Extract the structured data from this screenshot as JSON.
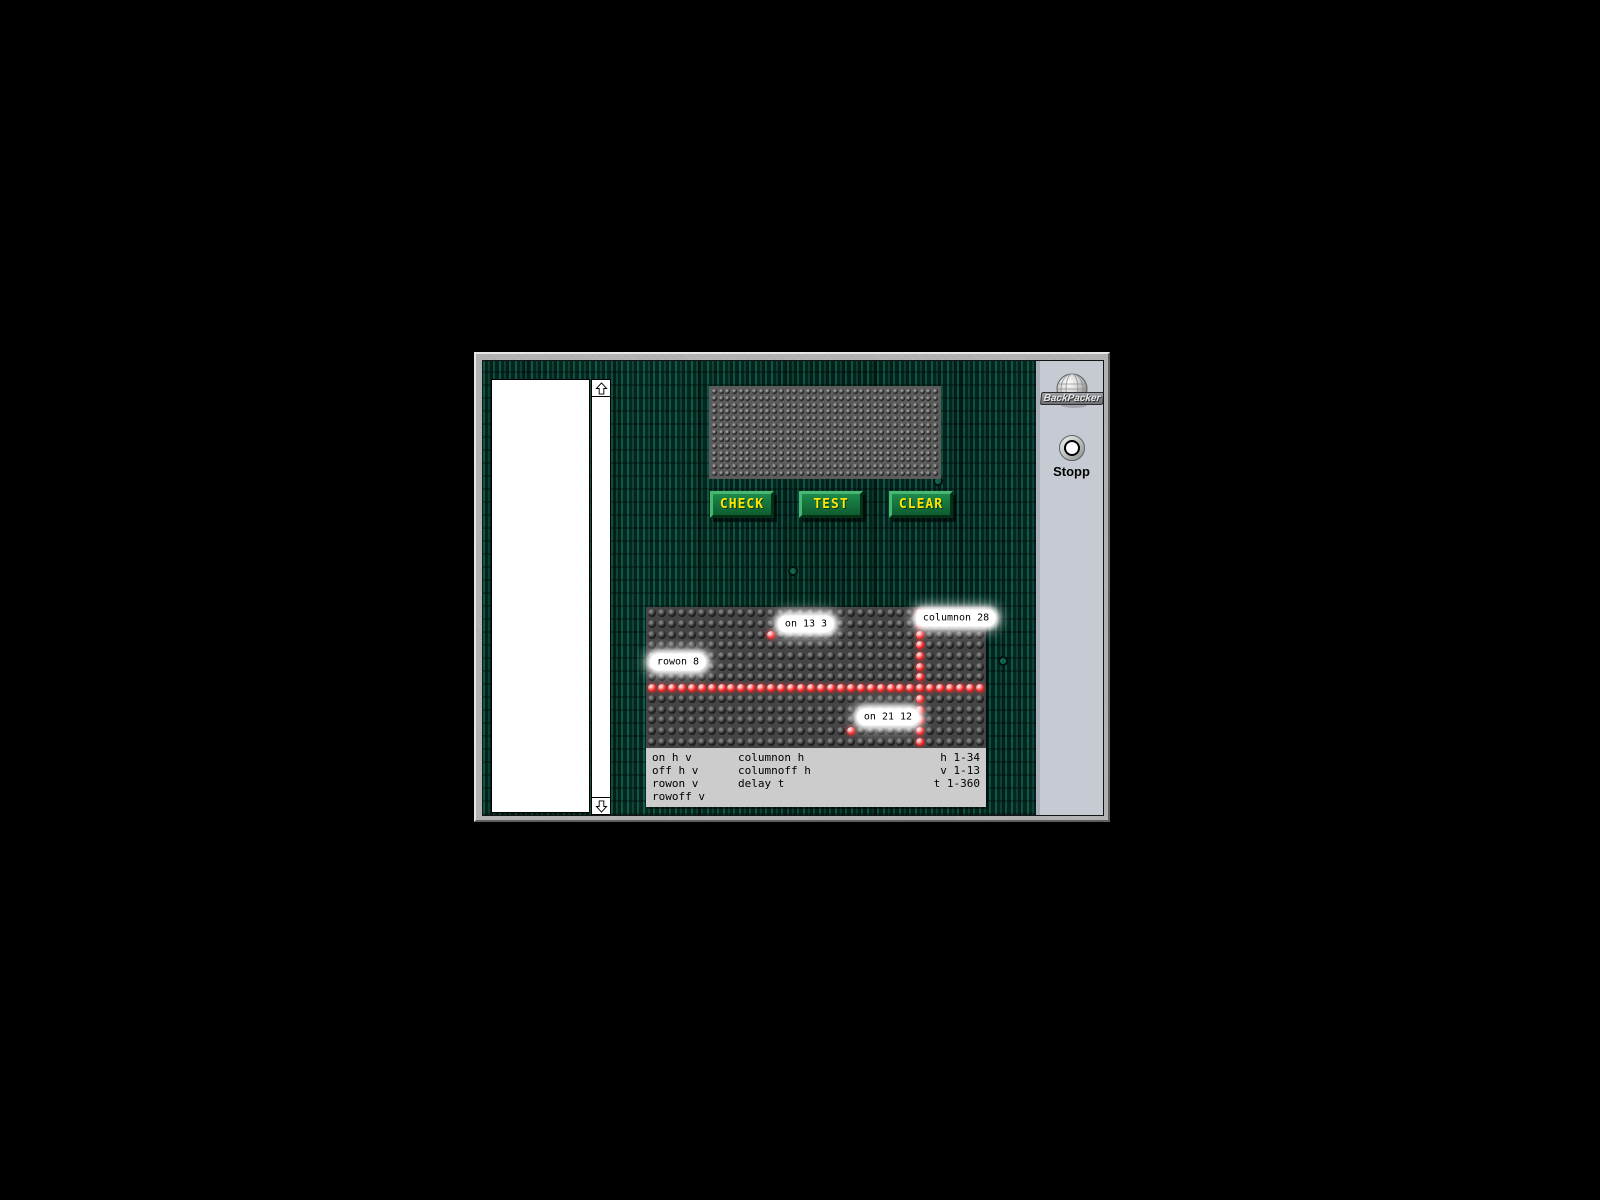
{
  "app": {
    "side_panel": {
      "logo_text": "BackPacker",
      "stop_button_label": "Stopp"
    },
    "editor": {
      "value": ""
    },
    "buttons": {
      "check": "CHECK",
      "test": "TEST",
      "clear": "CLEAR"
    },
    "led_display": {
      "cols": 34,
      "rows": 13,
      "lit_points": []
    },
    "simulator": {
      "cols": 34,
      "rows": 13,
      "lit_row": 8,
      "lit_column": 28,
      "lit_points": [
        [
          13,
          3
        ],
        [
          21,
          12
        ]
      ],
      "annotations": [
        {
          "text": "on 13 3",
          "cx": 160,
          "cy": 17
        },
        {
          "text": "columnon 28",
          "cx": 310,
          "cy": 11
        },
        {
          "text": "rowon 8",
          "cx": 32,
          "cy": 55
        },
        {
          "text": "on 21 12",
          "cx": 242,
          "cy": 110
        }
      ],
      "legend": {
        "col1": [
          "on h v",
          "off h v",
          "rowon v",
          "rowoff v"
        ],
        "col2": [
          "columnon h",
          "columnoff h",
          "delay t"
        ],
        "col3": [
          "h 1-34",
          "v 1-13",
          "t 1-360"
        ]
      }
    },
    "colors": {
      "led_on": "#ff2e2e",
      "button_face": "#13743b",
      "button_text": "#ffe600",
      "side_panel_bg": "#c6cbd3",
      "legend_bg": "#cccccc",
      "circuit_base": "#04211b"
    }
  }
}
